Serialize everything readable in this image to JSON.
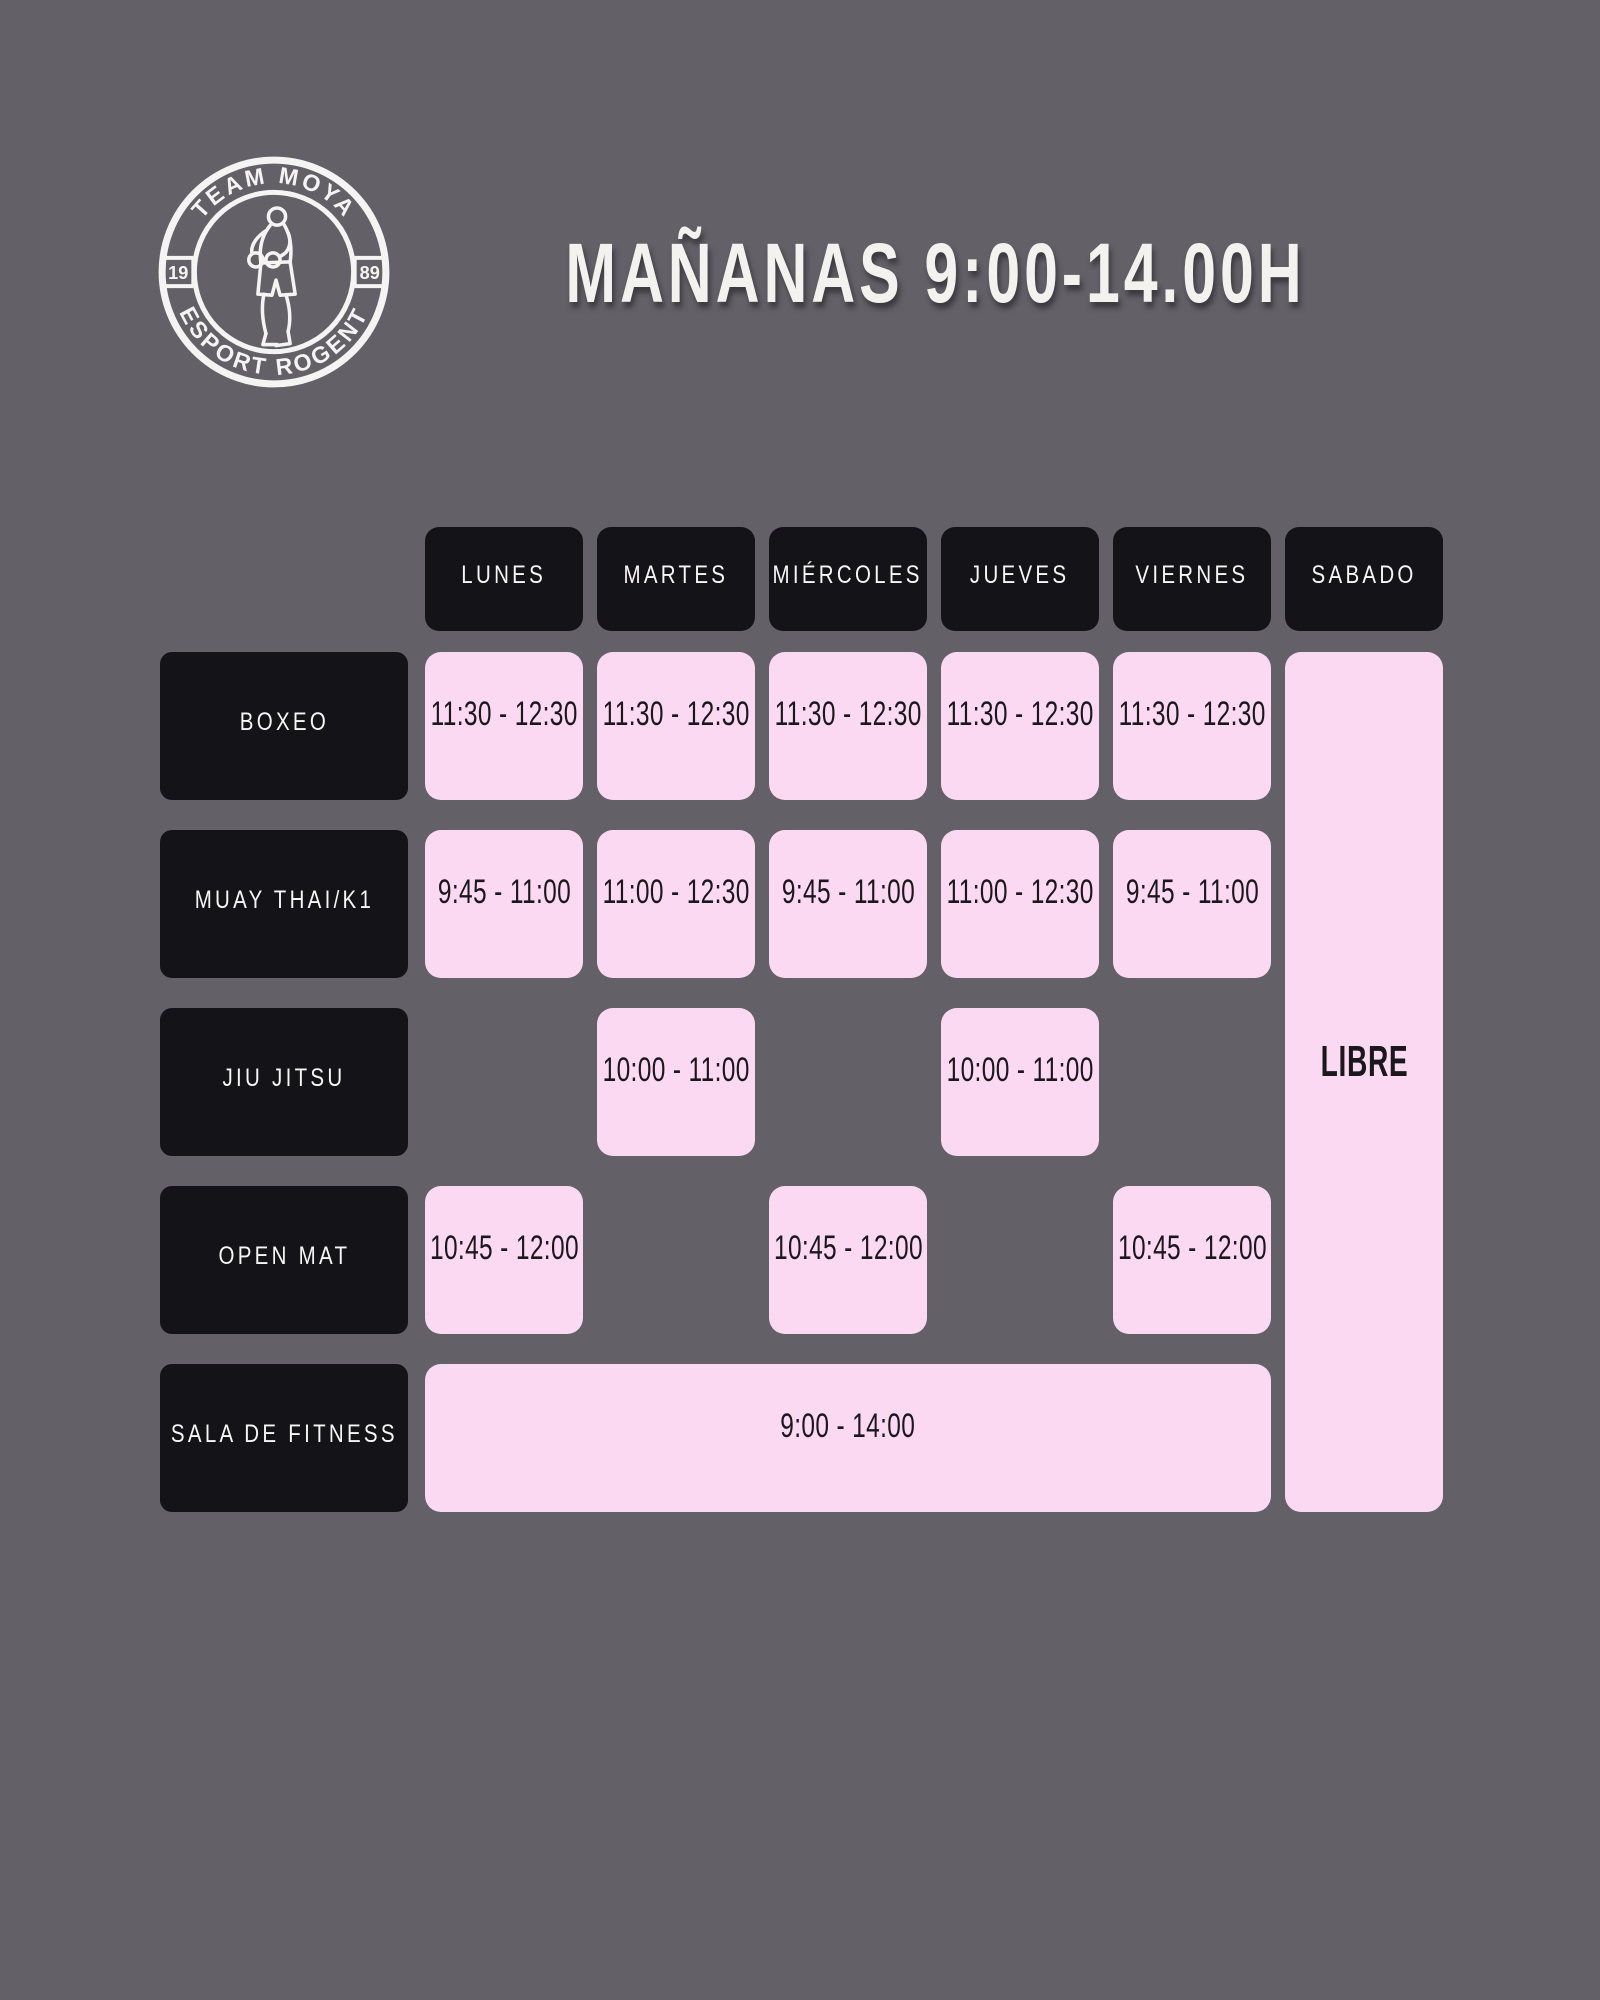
{
  "page": {
    "type": "gym-morning-schedule-poster"
  },
  "colors": {
    "background": "#636067",
    "dark_box": "#131318",
    "pink_cell": "#fbd9f2",
    "light_text": "#f3f2ee",
    "dark_text": "#1b181d"
  },
  "logo": {
    "arc_top": "TEAM MOYA",
    "arc_bottom": "ESPORT ROGENT",
    "year_left": "19",
    "year_right": "89",
    "figure": "boxer-icon"
  },
  "header": {
    "title": "MAÑANAS 9:00-14.00H"
  },
  "schedule": {
    "days": [
      "LUNES",
      "MARTES",
      "MIÉRCOLES",
      "JUEVES",
      "VIERNES",
      "SABADO"
    ],
    "rows": [
      {
        "label": "BOXEO",
        "times": [
          "11:30 - 12:30",
          "11:30 - 12:30",
          "11:30 - 12:30",
          "11:30 - 12:30",
          "11:30 - 12:30"
        ]
      },
      {
        "label": "MUAY THAI/K1",
        "times": [
          "9:45 - 11:00",
          "11:00 - 12:30",
          "9:45 - 11:00",
          "11:00 - 12:30",
          "9:45 - 11:00"
        ]
      },
      {
        "label": "JIU JITSU",
        "times": [
          null,
          "10:00 - 11:00",
          null,
          "10:00 - 11:00",
          null
        ]
      },
      {
        "label": "OPEN MAT",
        "times": [
          "10:45 - 12:00",
          null,
          "10:45 - 12:00",
          null,
          "10:45 - 12:00"
        ]
      },
      {
        "label": "SALA DE FITNESS",
        "merged_time": "9:00 - 14:00",
        "merged_span": "LUNES-VIERNES"
      }
    ],
    "saturday": {
      "note": "LIBRE"
    }
  }
}
